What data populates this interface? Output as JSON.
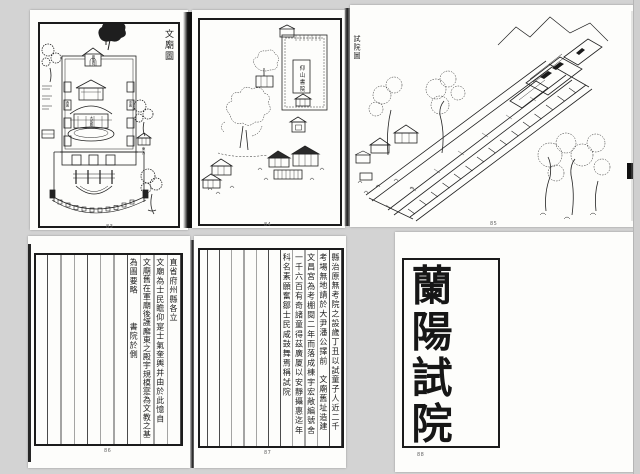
{
  "palette": {
    "background": "#d3d3d3",
    "paper": "#fdfdfb",
    "ink": "#1b1b1b"
  },
  "pages": {
    "wenmiao": {
      "title": "文廟圖",
      "shrine_label": "崇聖祠",
      "hall_label": "大成殿",
      "west_wing_label": "西廡",
      "east_wing_label": "東廡",
      "east_note": "東方",
      "page_mark": "83"
    },
    "shuyuan": {
      "academy_label": "仰山書院",
      "page_mark": "84"
    },
    "shiyuan": {
      "caption": "試院圖",
      "page_mark": "85"
    },
    "record1": {
      "columns": [
        "直省府州縣各立",
        "文廟為士民瞻仰寔士氣奎輿并由於此憶自",
        "文廟舊在軍廟後護廨東之殿宇規模寔為文教之基",
        "為圖要略　　　書院於側"
      ],
      "page_mark": "86"
    },
    "record2": {
      "columns": [
        "縣治原無考院之設歲丁丑以試童子人近二千",
        "考場無地請於大尹潘公擇前　文廟舊址造建",
        "文昌宮為考棚閱二年而落成棟宇宏敞編號舍",
        "一千六百有奇諸童得茲廣厦以安靜攝惠迄年",
        "科名素願奮鄒士民咸鼓舞焉稱試院"
      ],
      "page_mark": "87"
    },
    "seal": {
      "chars": [
        "蘭",
        "陽",
        "試",
        "院"
      ],
      "page_mark": "88"
    }
  }
}
